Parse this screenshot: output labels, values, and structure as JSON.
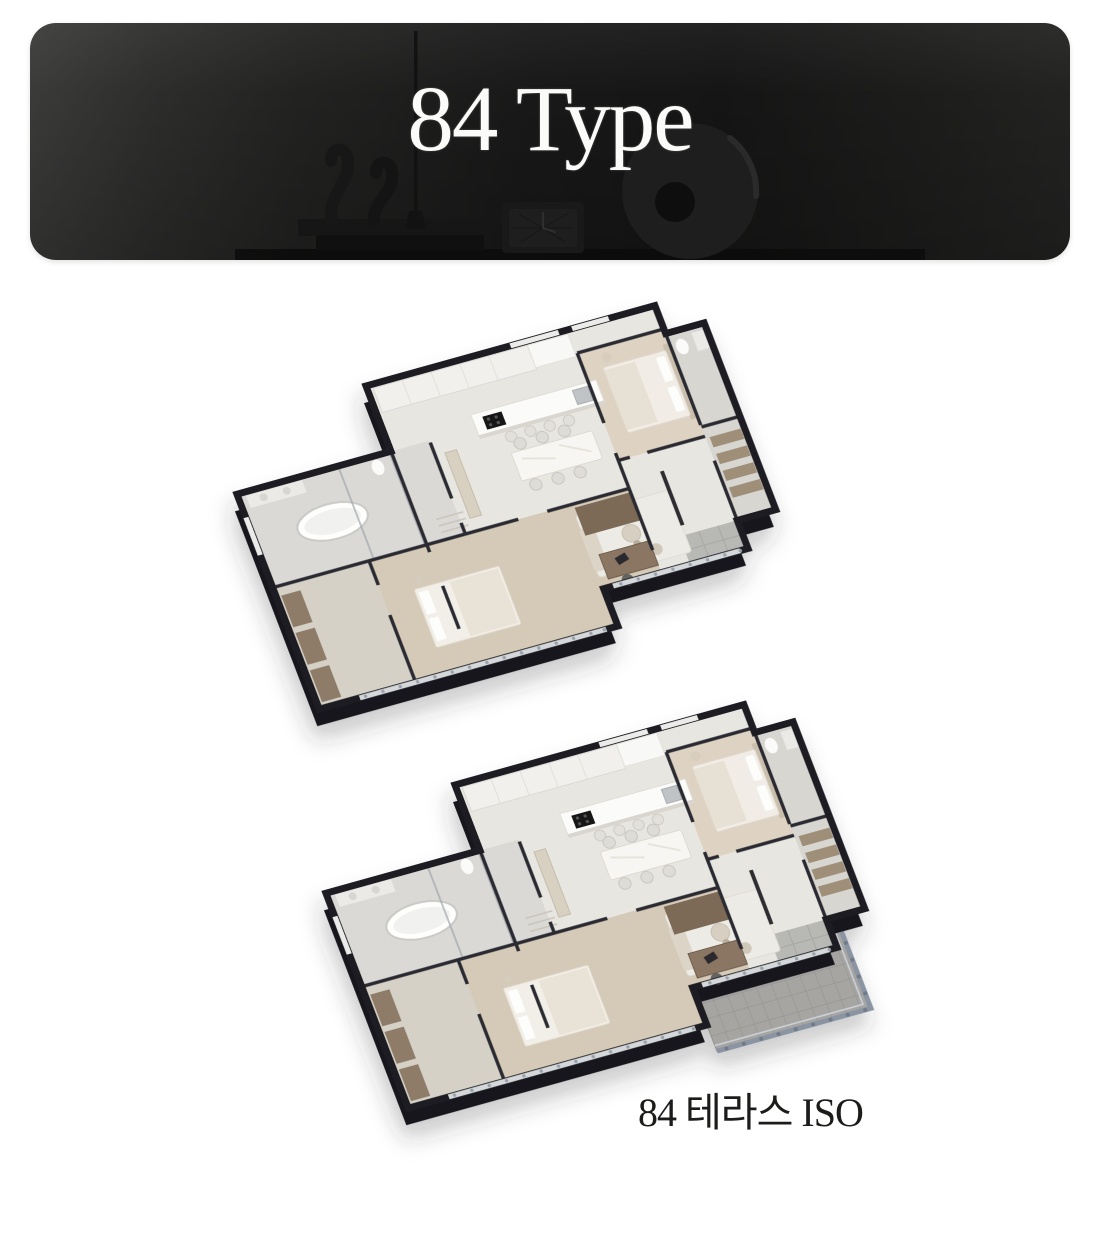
{
  "banner": {
    "title": "84 Type",
    "text_color": "#fbfbfa",
    "decor_icons": [
      "book-stack-icon",
      "wave-sculpture-icon",
      "candle-icon",
      "table-clock-icon",
      "ring-sculpture-icon"
    ]
  },
  "caption": {
    "terrace_iso": "84 테라스 ISO"
  },
  "colors": {
    "page_bg": "#ffffff",
    "banner_bg": "#1d1d1c",
    "wall": "#1e1e23",
    "slab": "#17171c",
    "floor": "#e8e6e1",
    "wood_floor": "#d3c5b2",
    "bath_floor": "#dbd9d5",
    "terrace_deck": "#a6a5a2",
    "terrace_rail": "#8a94a2",
    "caption_text": "#1c1c1b"
  }
}
